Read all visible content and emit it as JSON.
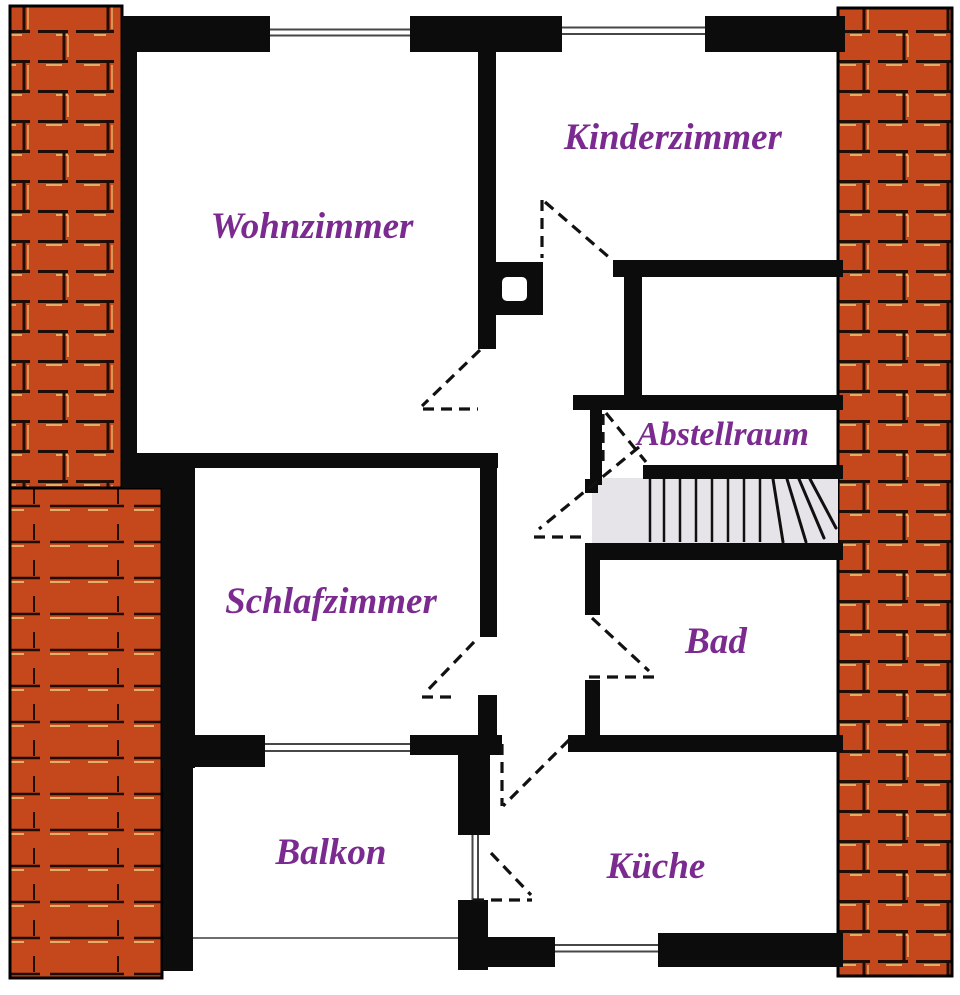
{
  "title": "Wohnungsgrundriss (apartment floor plan)",
  "colors": {
    "wall": "#0c0c0c",
    "brick": "#c5471c",
    "brick_dark": "#200d05",
    "brick_light": "#e2af66",
    "stair": "#e6e4e8",
    "label": "#7b2b8f",
    "window": "#474747",
    "railing": "#6e6e6e",
    "bg": "#ffffff"
  },
  "rooms": [
    {
      "id": "wohnzimmer",
      "label": "Wohnzimmer"
    },
    {
      "id": "kinderzimmer",
      "label": "Kinderzimmer"
    },
    {
      "id": "abstellraum",
      "label": "Abstellraum"
    },
    {
      "id": "schlafzimmer",
      "label": "Schlafzimmer"
    },
    {
      "id": "bad",
      "label": "Bad"
    },
    {
      "id": "balkon",
      "label": "Balkon"
    },
    {
      "id": "kueche",
      "label": "Küche"
    }
  ],
  "features": {
    "staircase_straight_steps": 8,
    "staircase_winder_steps": 4,
    "door_swings": 8,
    "windows": 5,
    "chimney_shaft": 1
  }
}
